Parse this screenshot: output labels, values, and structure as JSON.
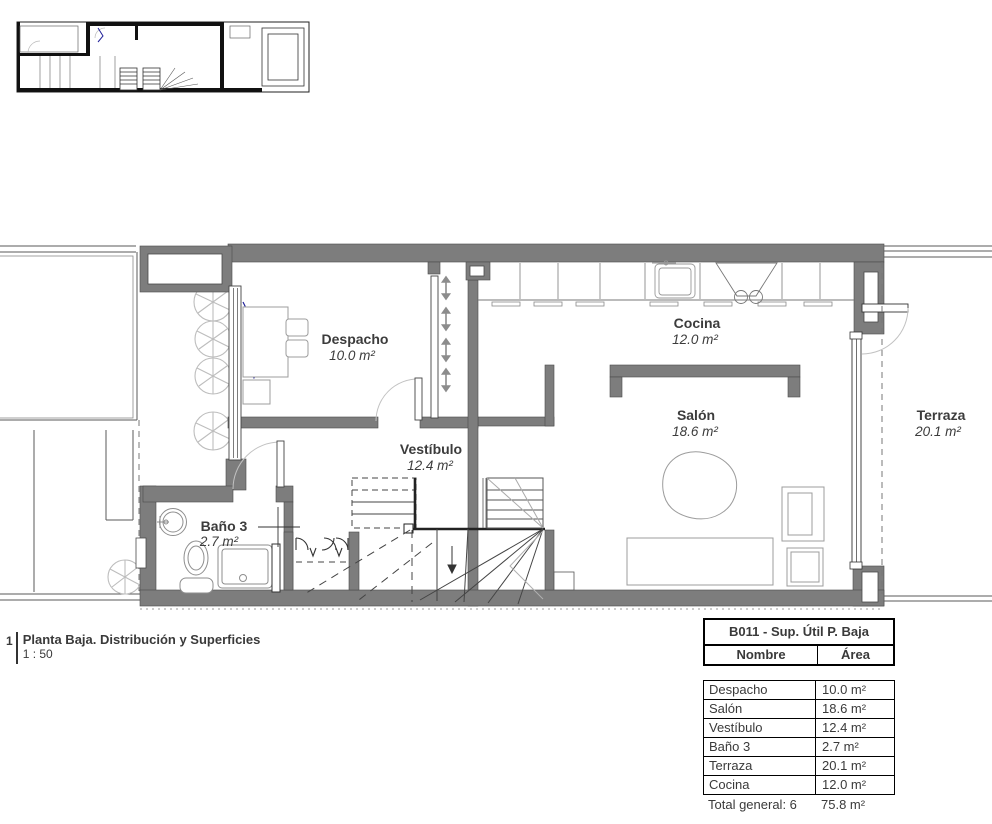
{
  "drawing": {
    "kind": "floor-plan",
    "key_plan": "miniature overview of ground floor"
  },
  "plan": {
    "rooms": [
      {
        "id": "despacho",
        "label": "Despacho",
        "area": "10.0 m²"
      },
      {
        "id": "cocina",
        "label": "Cocina",
        "area": "12.0 m²"
      },
      {
        "id": "salon",
        "label": "Salón",
        "area": "18.6 m²"
      },
      {
        "id": "vestibulo",
        "label": "Vestíbulo",
        "area": "12.4 m²"
      },
      {
        "id": "bano3",
        "label": "Baño 3",
        "area": "2.7 m²"
      },
      {
        "id": "terraza",
        "label": "Terraza",
        "area": "20.1 m²"
      }
    ]
  },
  "view_title": {
    "number": "1",
    "name": "Planta Baja. Distribución y Superficies",
    "scale": "1 : 50"
  },
  "schedule": {
    "title": "B011 - Sup. Útil P. Baja",
    "columns": [
      "Nombre",
      "Área"
    ],
    "rows": [
      [
        "Despacho",
        "10.0 m²"
      ],
      [
        "Salón",
        "18.6 m²"
      ],
      [
        "Vestíbulo",
        "12.4 m²"
      ],
      [
        "Baño 3",
        "2.7 m²"
      ],
      [
        "Terraza",
        "20.1 m²"
      ],
      [
        "Cocina",
        "12.0 m²"
      ]
    ],
    "total": {
      "label": "Total general: 6",
      "value": "75.8 m²"
    }
  },
  "colors": {
    "wall": "#7d7d7d",
    "line": "#4d4d4d",
    "furniture": "#9c9c9c",
    "tree": "#bdbdbd",
    "door_arc": "#c2c2c2",
    "window_dash_accent": "#22229a",
    "text": "#3c3c3c"
  }
}
